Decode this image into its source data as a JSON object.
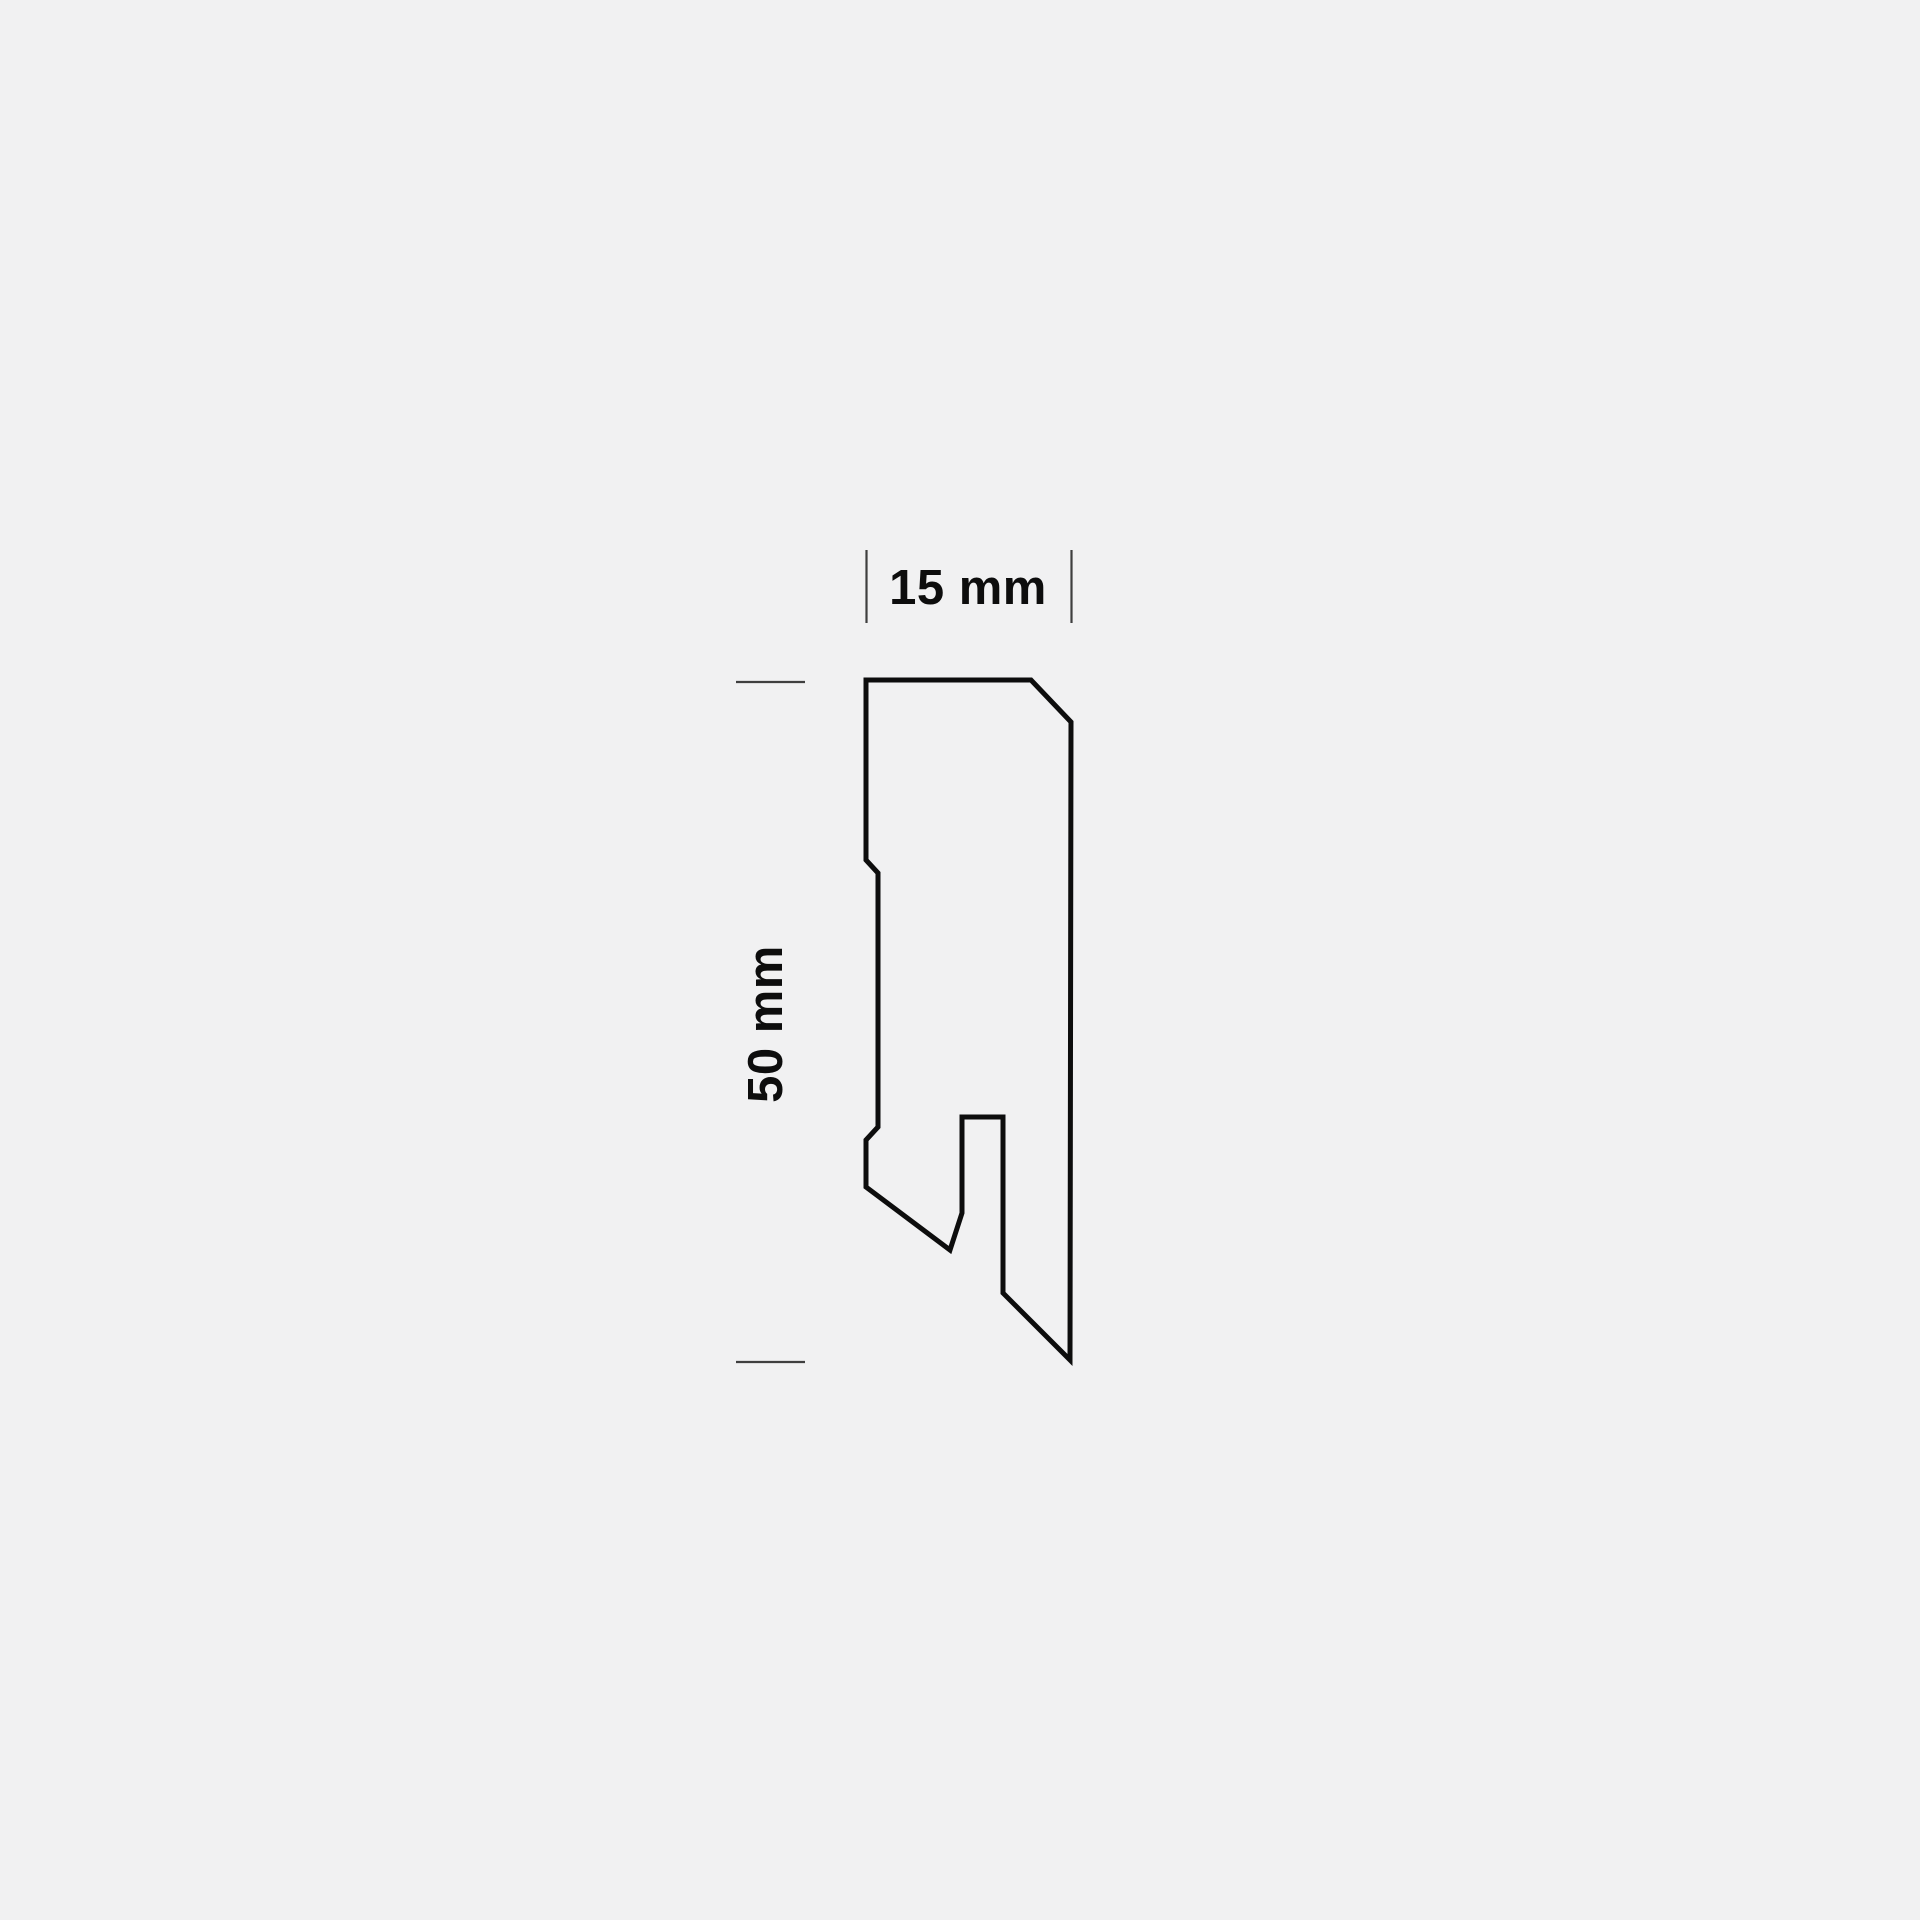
{
  "page": {
    "background_color": "#f1f1f2"
  },
  "diagram": {
    "kind": "skirting-board-profile-cross-section",
    "outline_color": "#0d0d0d",
    "tick_color": "#3f3f3f",
    "label_color": "#0d0d0d",
    "profile_points": "866,680 1031,680 1071,722 1070,1360 1003,1293 1003,1117 962,1117 962,1213 950,1250 866,1187 866,1140 878,1127 878,873 866,860",
    "width_dimension": {
      "label": "15 mm",
      "value_mm": 15
    },
    "height_dimension": {
      "label": "50 mm",
      "value_mm": 50
    }
  }
}
